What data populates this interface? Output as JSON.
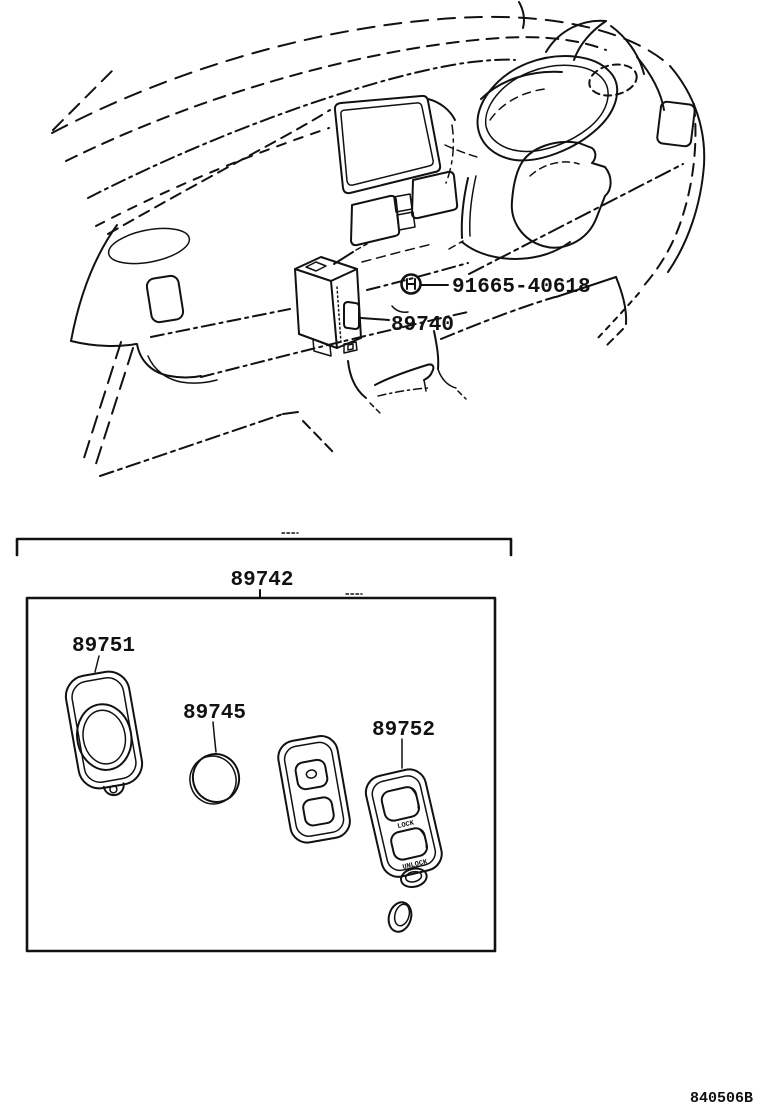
{
  "page": {
    "doc_number": "840506B"
  },
  "colors": {
    "ink": "#111111",
    "background": "#ffffff"
  },
  "callouts": {
    "screw": "91665-40618",
    "receiver": "89740",
    "transmitter_set": "89742",
    "transmitter_cover": "89751",
    "battery_cover": "89745",
    "transmitter": "89752"
  },
  "fob_buttons": {
    "lock": "LOCK",
    "unlock": "UNLOCK"
  }
}
